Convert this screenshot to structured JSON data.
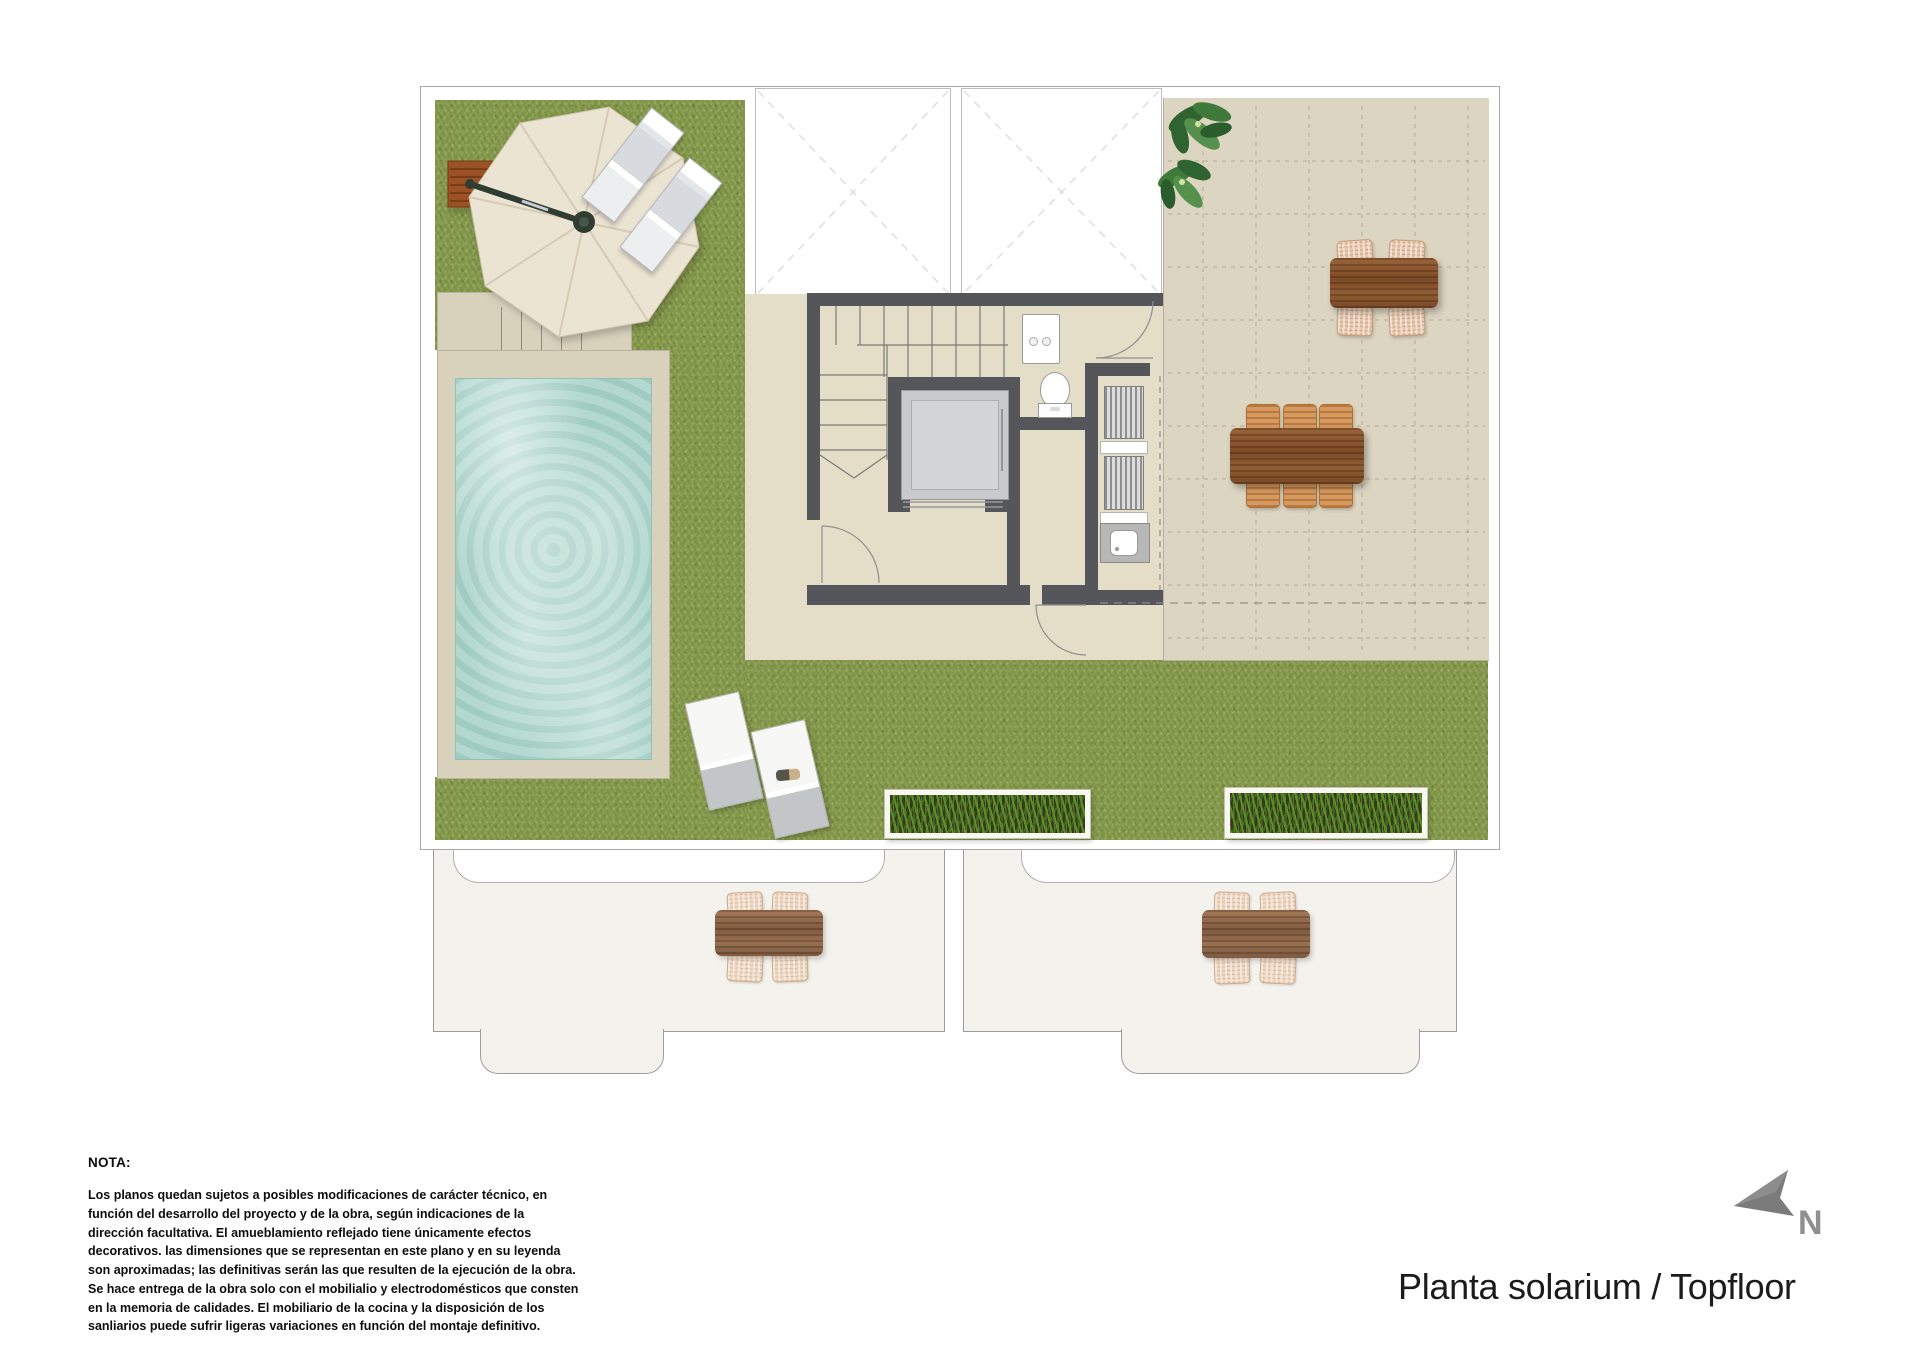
{
  "title": {
    "text": "Planta solarium / Topfloor"
  },
  "north": {
    "label": "N"
  },
  "note": {
    "heading": "NOTA:",
    "body": "Los planos quedan sujetos a posibles modificaciones de carácter técnico, en función del desarrollo del proyecto y de la obra, según indicaciones de la dirección facultativa. El amueblamiento reflejado tiene únicamente efectos decorativos. las dimensiones que se representan en este plano y en su leyenda son aproximadas; las definitivas serán las que resulten de la ejecución de la obra. Se hace entrega de la obra solo con el mobilialio y electrodomésticos que consten en la memoria de calidades. El mobiliario de la cocina y la disposición de los sanliarios puede sufrir ligeras variaciones en función del montaje definitivo."
  },
  "features": [
    "lawn",
    "swimming-pool",
    "pool-deck",
    "parasol",
    "sun-loungers",
    "skylights",
    "staircase",
    "elevator",
    "toilet",
    "washbasin",
    "wardrobe-louvers",
    "kitchenette-sink",
    "tiled-terrace",
    "dining-tables",
    "plant",
    "planters",
    "lower-floor-terraces",
    "north-arrow"
  ],
  "colors": {
    "grass": "#85994c",
    "floor": "#e4ddc8",
    "terrace": "#dcd5c1",
    "deck": "#d8d2bd",
    "water": "#b2d8cf",
    "wall": "#54565a",
    "wood": "#8a5a33",
    "wicker": "#e7c7ae",
    "wicker_orange": "#d8995f",
    "lower": "#f3f2ec",
    "umbrella": "#ece4d3",
    "notetext": "#0d0d0d"
  }
}
